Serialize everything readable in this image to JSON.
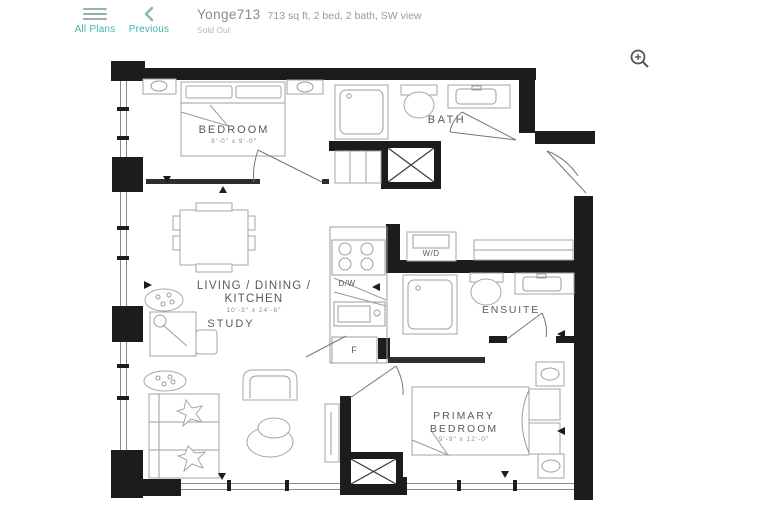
{
  "header": {
    "all_plans_label": "All Plans",
    "previous_label": "Previous",
    "title": "Yonge713",
    "subtitle": "713 sq ft, 2 bed, 2 bath, SW view",
    "status": "Sold Out",
    "accent_color": "#3fb3a6"
  },
  "toolbar": {
    "zoom_tooltip": "Zoom in"
  },
  "floorplan": {
    "bedroom": {
      "name": "BEDROOM",
      "dims": "8'-0\" x 9'-0\""
    },
    "bath": {
      "name": "BATH"
    },
    "living": {
      "line1": "LIVING / DINING /",
      "line2": "KITCHEN",
      "dims": "10'-3\" x 24'-6\""
    },
    "study": {
      "name": "STUDY"
    },
    "dw": {
      "label": "D/W"
    },
    "fridge": {
      "label": "F"
    },
    "wd": {
      "label": "W/D"
    },
    "ensuite": {
      "name": "ENSUITE"
    },
    "primary": {
      "line1": "PRIMARY",
      "line2": "BEDROOM",
      "dims": "9'-9\" x 12'-0\""
    }
  }
}
